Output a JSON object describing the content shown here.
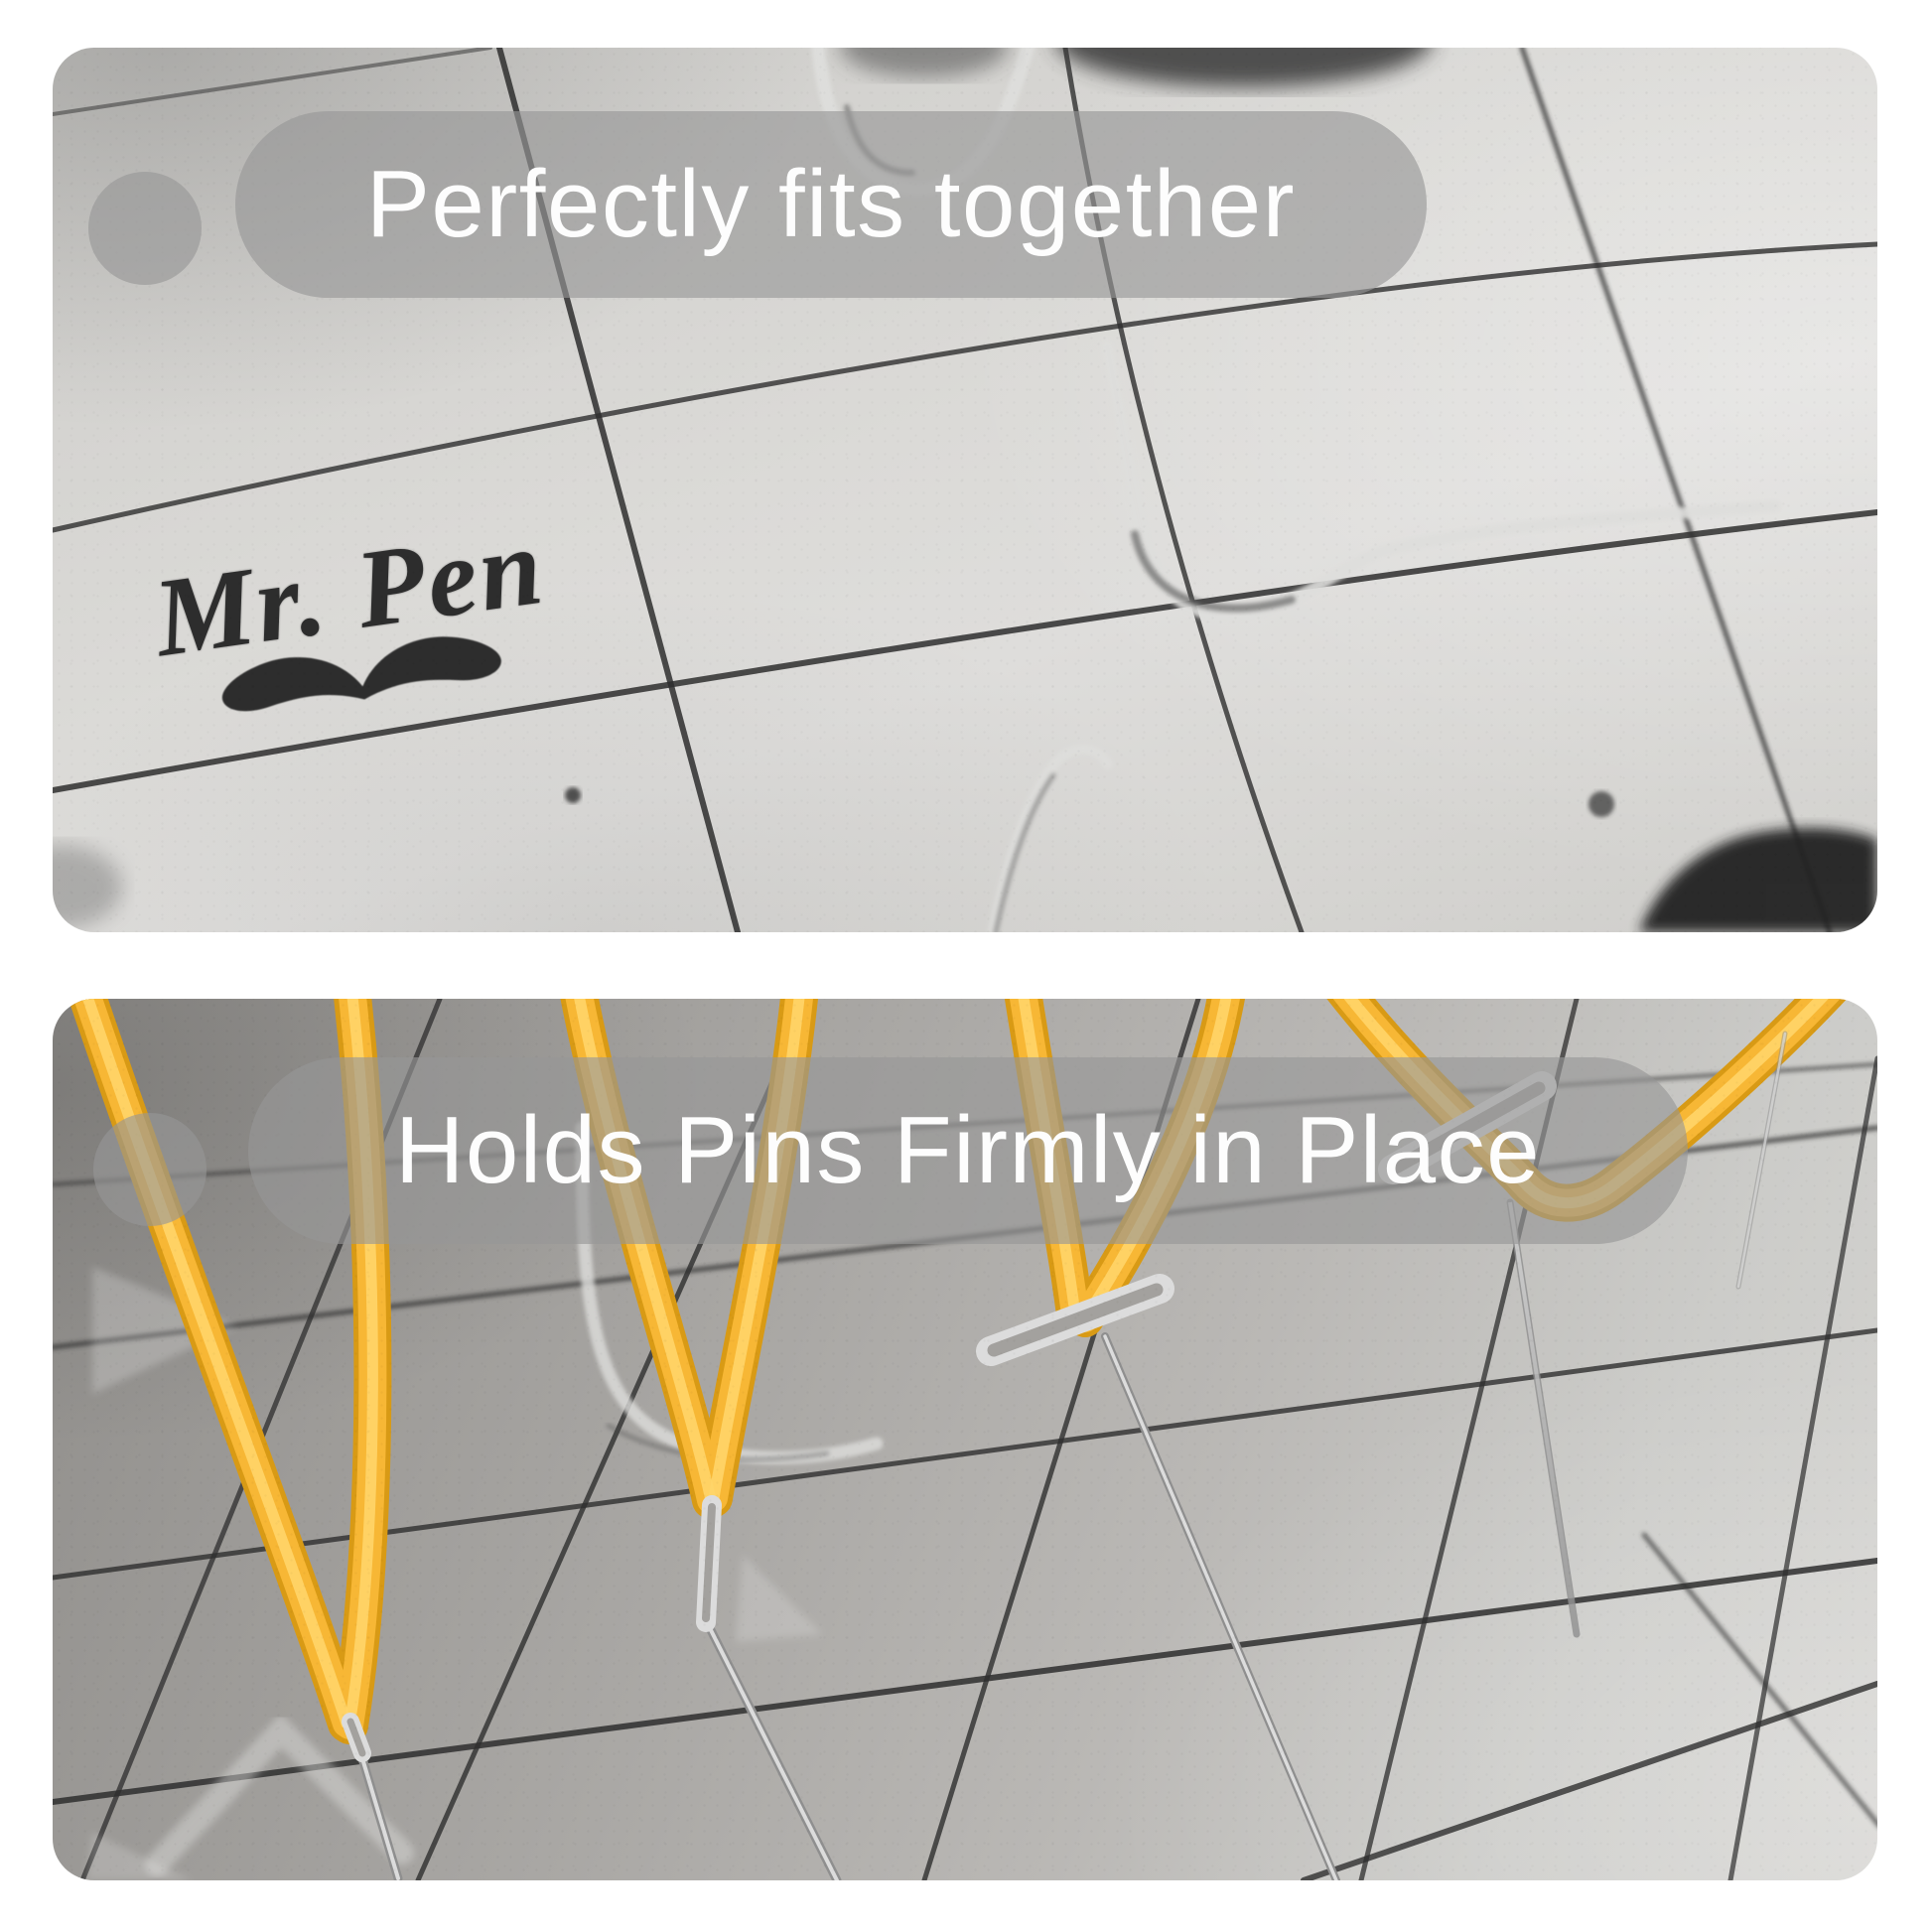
{
  "image_type": "product-feature-photo-collage",
  "panels": {
    "top": {
      "caption": "Perfectly fits together",
      "brand": "Mr. Pen",
      "subject": "interlocking foam blocking mat with grid lines"
    },
    "bottom": {
      "caption": "Holds Pins Firmly in Place",
      "subject": "T-pins holding yellow yarn loops on gridded blocking mat"
    }
  },
  "colors": {
    "page_bg": "#ffffff",
    "pill": "rgba(150,150,150,0.63)",
    "caption_text": "#fdfdfd",
    "grid_line": "#2e2e2e",
    "yarn": "#f7b735",
    "yarn_dark": "#d89a15",
    "yarn_light": "#ffd569",
    "pin_silver": "#dcdcdc",
    "pin_shadow": "#8f8f8f",
    "logo_ink": "#2d2d2d"
  }
}
